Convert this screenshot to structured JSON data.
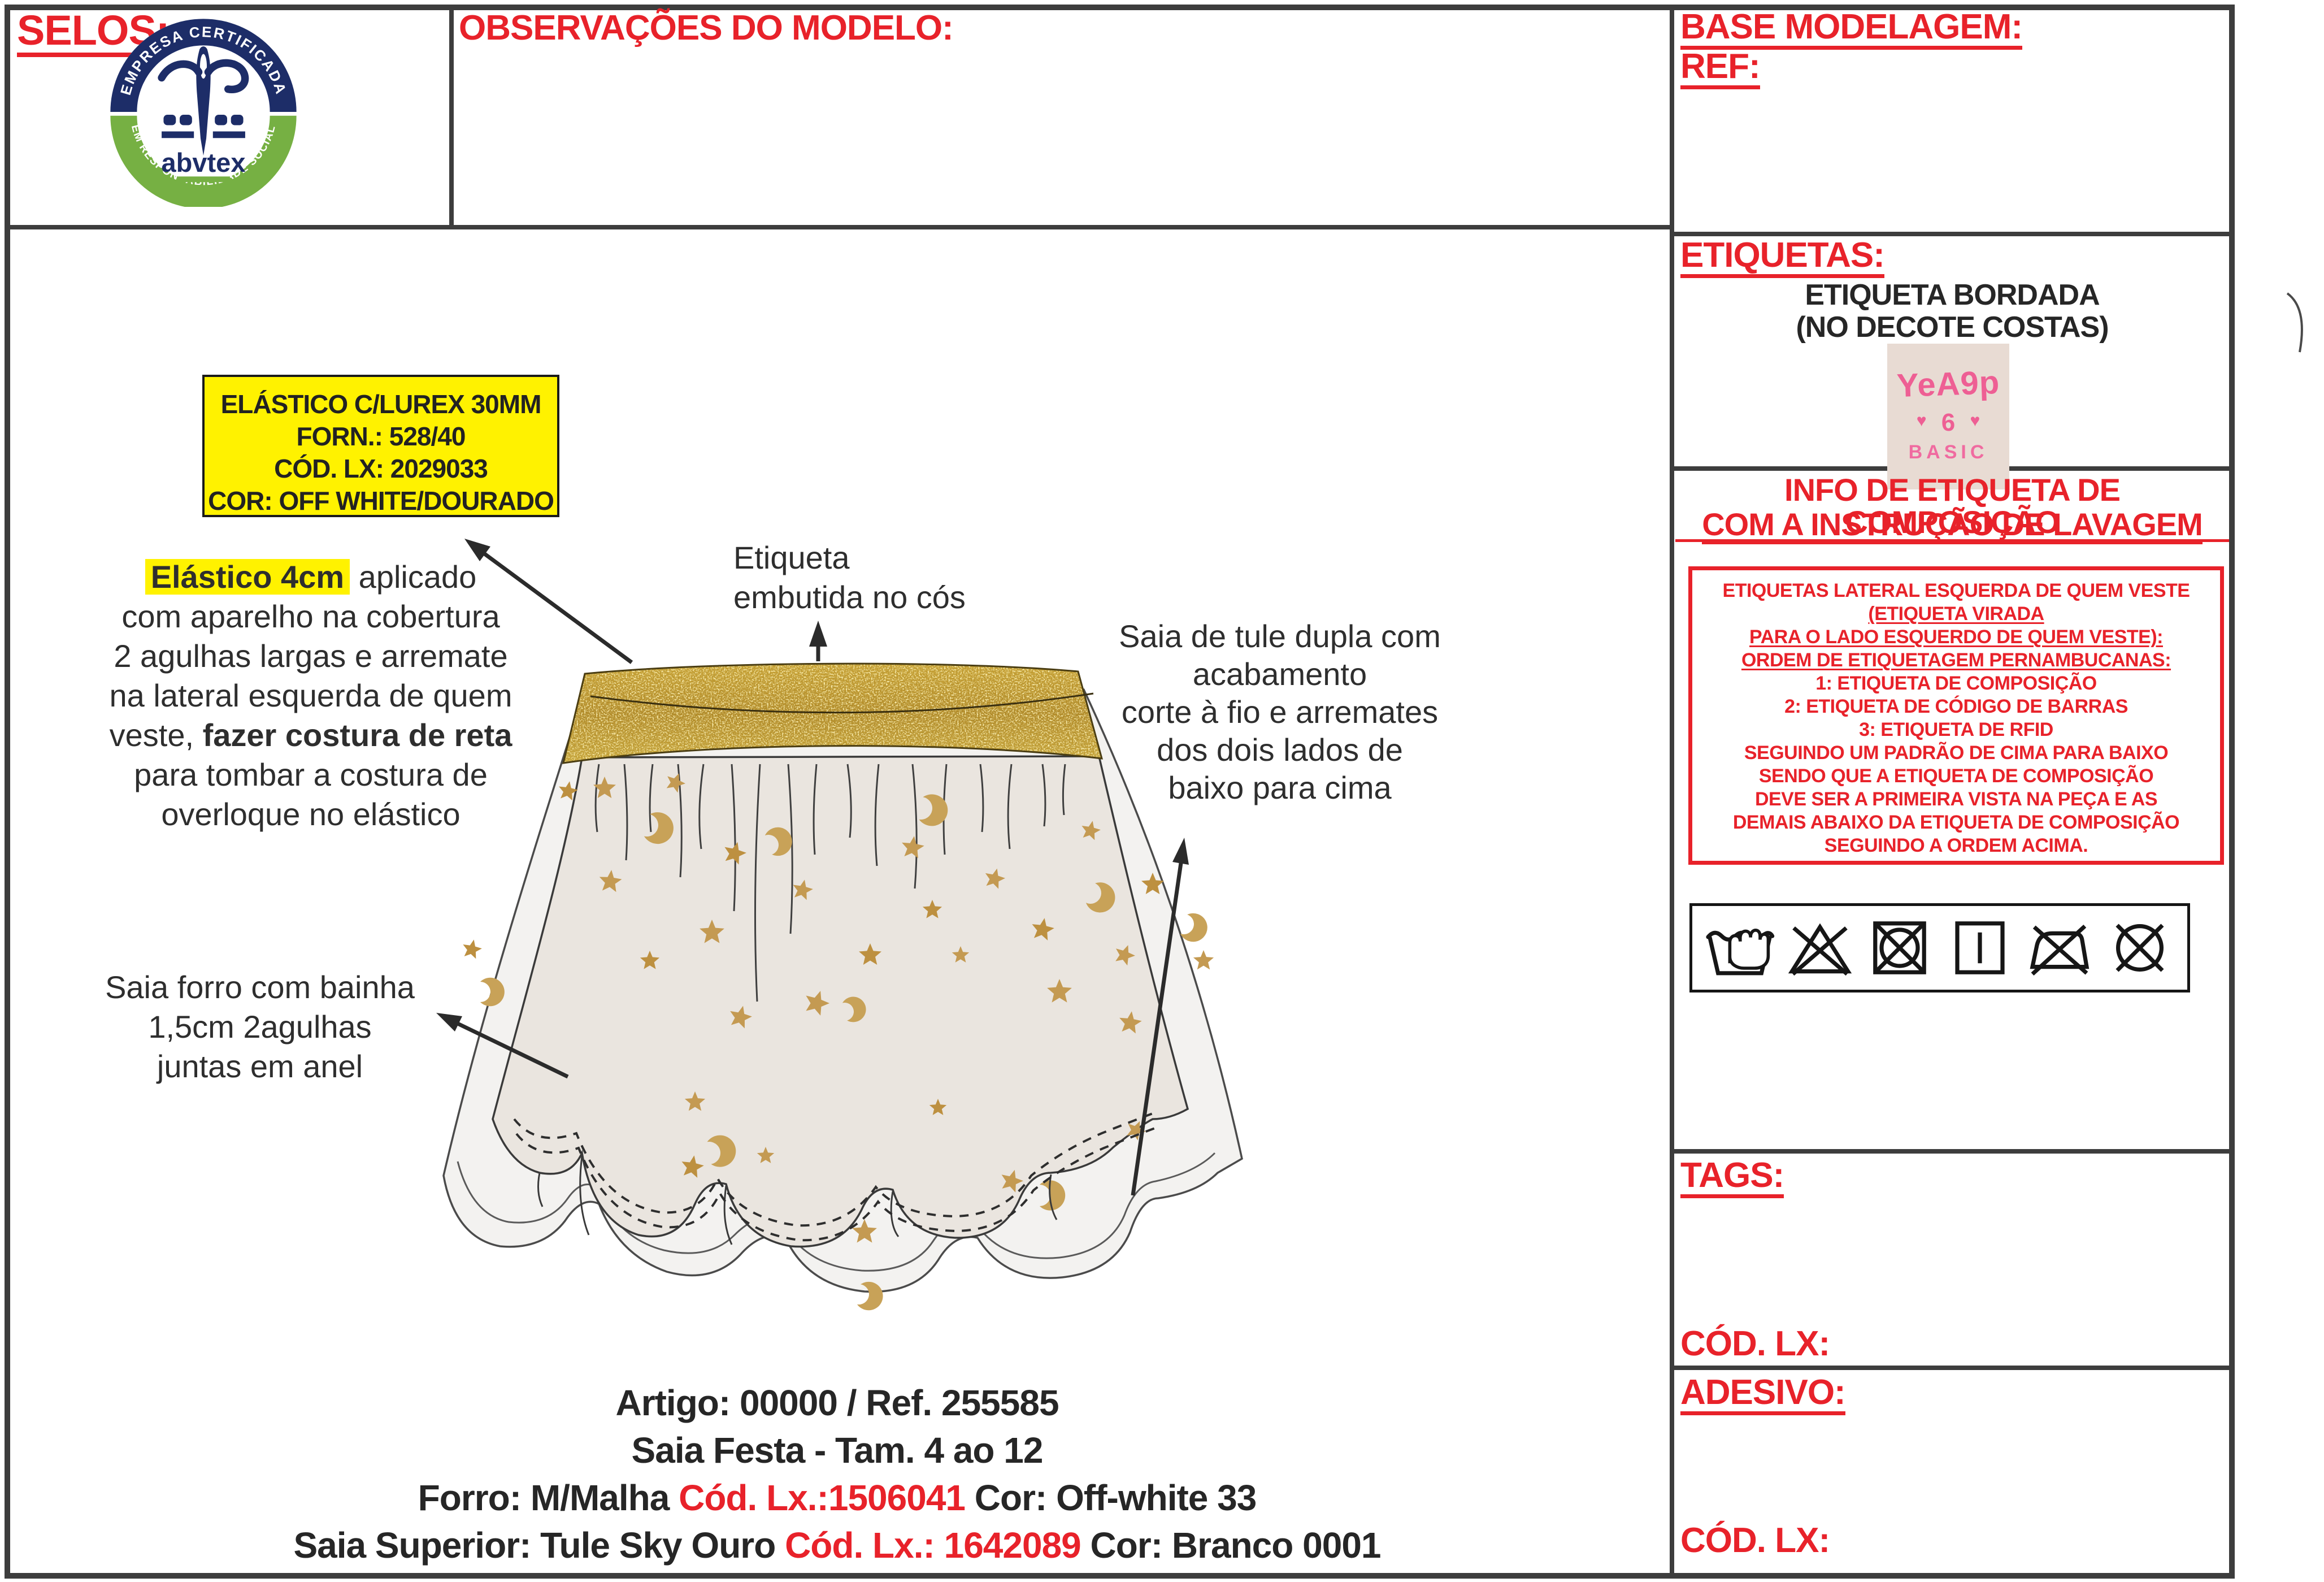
{
  "colors": {
    "accent_red": "#e8222a",
    "highlight_yellow": "#fff200",
    "waistband_gold": "#c9a227",
    "star_gold": "#c49a52",
    "logo_navy": "#1d2d68",
    "logo_green": "#76b043",
    "label_pink": "#ee5f94",
    "label_bg": "#e8dbd3",
    "lining_beige": "#eae5df",
    "tulle_white": "#f3f2f0"
  },
  "top": {
    "selos": "SELOS:",
    "observacoes": "OBSERVAÇÕES DO MODELO:",
    "base_modelagem": "BASE MODELAGEM:",
    "ref": "REF:"
  },
  "logo": {
    "arc_top": "EMPRESA CERTIFICADA",
    "arc_bottom": "EM RESPONSABILIDADE SOCIAL",
    "brand": "abvtex"
  },
  "etiquetas": {
    "title": "ETIQUETAS:",
    "subtitle_l1": "ETIQUETA BORDADA",
    "subtitle_l2": "(NO DECOTE COSTAS)",
    "label": {
      "brand": "YeA9p",
      "heart_left": "♥",
      "size": "6",
      "heart_right": "♥",
      "basic": "BASIC"
    }
  },
  "info": {
    "title_l1": "INFO DE ETIQUETA DE COMPOSIÇÃO",
    "title_l2": "COM A INSTRUÇÃO DE LAVAGEM",
    "box_lines": [
      "ETIQUETAS LATERAL ESQUERDA DE QUEM VESTE",
      "(ETIQUETA VIRADA",
      "PARA O LADO ESQUERDO DE QUEM VESTE):",
      "ORDEM DE ETIQUETAGEM PERNAMBUCANAS:",
      "1: ETIQUETA DE COMPOSIÇÃO",
      "2: ETIQUETA DE CÓDIGO DE BARRAS",
      "3: ETIQUETA DE RFID",
      "SEGUINDO UM PADRÃO DE CIMA PARA BAIXO",
      "SENDO QUE A ETIQUETA DE COMPOSIÇÃO",
      "DEVE SER A PRIMEIRA VISTA NA PEÇA E AS",
      "DEMAIS ABAIXO DA ETIQUETA DE COMPOSIÇÃO",
      "SEGUINDO A ORDEM ACIMA."
    ],
    "underlined_lines": [
      1,
      2,
      3
    ]
  },
  "care_symbols": [
    "hand-wash",
    "do-not-bleach",
    "do-not-tumble-dry",
    "line-dry",
    "do-not-iron",
    "do-not-dry-clean"
  ],
  "tags": {
    "title": "TAGS:",
    "cod_lx": "CÓD. LX:"
  },
  "adesivo": {
    "title": "ADESIVO:",
    "cod_lx": "CÓD. LX:"
  },
  "spec_box": {
    "l1": "ELÁSTICO C/LUREX 30MM",
    "l2": "FORN.: 528/40",
    "l3": "CÓD. LX: 2029033",
    "l4": "COR: OFF WHITE/DOURADO"
  },
  "notes": {
    "elastic": {
      "hl": "Elástico 4cm",
      "l1_rest": " aplicado",
      "l2": "com aparelho na cobertura",
      "l3": "2 agulhas largas e arremate",
      "l4": "na lateral esquerda de quem",
      "l5_pre": "veste, ",
      "l5_bold": "fazer costura de reta",
      "l6": "para tombar a costura de",
      "l7": "overloque no elástico"
    },
    "label_waist": {
      "l1": "Etiqueta",
      "l2": "embutida no cós"
    },
    "tulle": {
      "l1": "Saia de tule dupla com",
      "l2": "acabamento",
      "l3": "corte à fio e arremates",
      "l4": "dos dois lados de",
      "l5": "baixo para cima"
    },
    "lining": {
      "l1": "Saia forro com bainha",
      "l2": "1,5cm 2agulhas",
      "l3": "juntas em anel"
    }
  },
  "footer": {
    "l1": "Artigo: 00000 / Ref. 255585",
    "l2": "Saia Festa - Tam. 4 ao 12",
    "l3a": "Forro: M/Malha ",
    "l3b": "Cód. Lx.:1506041",
    "l3c": " Cor: Off-white 33",
    "l4a": "Saia Superior: Tule Sky Ouro ",
    "l4b": "Cód. Lx.: 1642089",
    "l4c": " Cor: Branco 0001"
  },
  "figure": {
    "stars": [
      [
        305,
        300,
        18,
        10
      ],
      [
        370,
        295,
        21,
        0
      ],
      [
        495,
        285,
        18,
        22
      ],
      [
        600,
        410,
        21,
        15
      ],
      [
        560,
        550,
        23,
        0
      ],
      [
        720,
        475,
        19,
        12
      ],
      [
        840,
        590,
        21,
        0
      ],
      [
        745,
        675,
        23,
        18
      ],
      [
        915,
        400,
        21,
        8
      ],
      [
        950,
        510,
        18,
        0
      ],
      [
        1060,
        455,
        19,
        14
      ],
      [
        1000,
        590,
        16,
        0
      ],
      [
        1145,
        545,
        21,
        10
      ],
      [
        1175,
        655,
        23,
        0
      ],
      [
        1290,
        590,
        19,
        20
      ],
      [
        1340,
        465,
        21,
        0
      ],
      [
        1230,
        370,
        18,
        12
      ],
      [
        380,
        460,
        21,
        6
      ],
      [
        450,
        600,
        18,
        0
      ],
      [
        610,
        700,
        21,
        14
      ],
      [
        530,
        850,
        19,
        0
      ],
      [
        525,
        965,
        21,
        10
      ],
      [
        830,
        1080,
        23,
        0
      ],
      [
        1090,
        990,
        21,
        16
      ],
      [
        960,
        860,
        16,
        0
      ],
      [
        1300,
        710,
        21,
        8
      ],
      [
        1430,
        600,
        19,
        0
      ],
      [
        135,
        580,
        18,
        12
      ],
      [
        655,
        945,
        16,
        0
      ],
      [
        1310,
        900,
        18,
        24
      ]
    ],
    "moons": [
      [
        445,
        360,
        20,
        15
      ],
      [
        660,
        395,
        18,
        -20
      ],
      [
        930,
        330,
        20,
        10
      ],
      [
        1230,
        480,
        19,
        25
      ],
      [
        150,
        655,
        18,
        0
      ],
      [
        555,
        940,
        20,
        -10
      ],
      [
        820,
        1190,
        18,
        10
      ],
      [
        1140,
        1015,
        19,
        0
      ],
      [
        1395,
        535,
        18,
        20
      ],
      [
        795,
        690,
        16,
        -15
      ]
    ],
    "gathers": [
      [
        360,
        120,
        -10
      ],
      [
        405,
        170,
        8
      ],
      [
        455,
        120,
        -8
      ],
      [
        500,
        200,
        10
      ],
      [
        545,
        150,
        -12
      ],
      [
        595,
        260,
        10
      ],
      [
        645,
        420,
        -14
      ],
      [
        695,
        300,
        12
      ],
      [
        745,
        160,
        -8
      ],
      [
        800,
        130,
        10
      ],
      [
        855,
        180,
        -10
      ],
      [
        915,
        220,
        12
      ],
      [
        975,
        160,
        -8
      ],
      [
        1035,
        120,
        8
      ],
      [
        1090,
        150,
        -10
      ],
      [
        1145,
        110,
        8
      ],
      [
        1185,
        90,
        -6
      ]
    ]
  }
}
